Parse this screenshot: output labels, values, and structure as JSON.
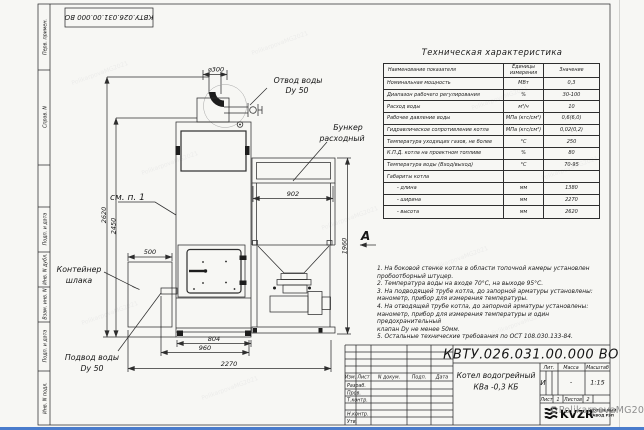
{
  "colors": {
    "bottom_bar": "#4a7ccc",
    "line_color": "#2e2e2e",
    "paper": "#f7f7f4",
    "watermark_gray": "#8f8f8f"
  },
  "page": {
    "doc_number_top": "КВТУ.026.031.00.000 ВО",
    "watermark": "©PolikarpovaMG2021",
    "watermark_tile": "PolikarpovaMG2021"
  },
  "border_column": {
    "labels": [
      "Перв. примен.",
      "Справ. N",
      "Подп. и дата",
      "Инв. N дубл.",
      "Взам. инв. N",
      "Подп. и дата",
      "Инв. N подл."
    ]
  },
  "tech_table": {
    "title": "Техническая характеристика",
    "headers": [
      "Наименование показателя",
      "Единицы измерения",
      "Значение"
    ],
    "rows": [
      {
        "name": "Номинальная мощность",
        "unit": "МВт",
        "value": "0,3"
      },
      {
        "name": "Диапазон рабочего регулирования",
        "unit": "%",
        "value": "30-100"
      },
      {
        "name": "Расход воды",
        "unit": "м³/ч",
        "value": "10"
      },
      {
        "name": "Рабочее давление воды",
        "unit": "МПа (кгс/см²)",
        "value": "0,6(6,0)"
      },
      {
        "name": "Гидравлическое сопротивление котла",
        "unit": "МПа (кгс/см²)",
        "value": "0,02(0,2)"
      },
      {
        "name": "Температура уходящих газов, не более",
        "unit": "°С",
        "value": "250"
      },
      {
        "name": "К.П.Д. котла на проектном топливе",
        "unit": "%",
        "value": "80"
      },
      {
        "name": "Температура воды (Вход/выход)",
        "unit": "°С",
        "value": "70-95"
      },
      {
        "name": "Габариты котла",
        "unit": "",
        "value": ""
      },
      {
        "name": "- длина",
        "unit": "мм",
        "value": "1380"
      },
      {
        "name": "- ширина",
        "unit": "мм",
        "value": "2270"
      },
      {
        "name": "- высота",
        "unit": "мм",
        "value": "2620"
      }
    ]
  },
  "notes": {
    "lines": [
      "1. На боковой стенке котла в области топочной камеры установлен",
      "пробоотборный штуцер.",
      "2. Температура воды на входе 70°С, на выходе 95°С.",
      "3. На подводящей трубе котла, до запорной арматуры установлены:",
      "манометр, прибор для измерения температуры.",
      "4. На отводящей трубе котла, до запорной арматуры установлены:",
      "манометр, прибор для измерения температуры и один предохранительный",
      "клапан Dy не менее 50мм.",
      "5. Остальные технические требования по ОСТ 108.030.133-84."
    ]
  },
  "drawing": {
    "view_label": "А",
    "see_note": "см. п. 1",
    "labels": {
      "water_outlet_1": "Отвод воды",
      "water_outlet_2": "Dy 50",
      "hopper_1": "Бункер",
      "hopper_2": "расходный",
      "slag_1": "Контейнер",
      "slag_2": "шлака",
      "water_inlet_1": "Подвод воды",
      "water_inlet_2": "Dy 50"
    },
    "dims": {
      "chimney": "⌀300",
      "hopper_w": "902",
      "slag_w": "500",
      "boiler_w": "804",
      "base_w": "960",
      "total_w": "2270",
      "total_h": "2620",
      "body_h": "2450",
      "hopper_h": "1960"
    }
  },
  "title_block": {
    "doc_number": "КВТУ.026.031.00.000 ВО",
    "cols": [
      "Изм.",
      "Лист",
      "N докум.",
      "Подп.",
      "Дата"
    ],
    "rows": [
      "Разраб.",
      "Пров.",
      "Т.контр.",
      "Н.контр.",
      "Утв."
    ],
    "product_line1": "Котел водогрейный",
    "product_line2": "КВа -0,3 КБ",
    "lit_label": "Лит.",
    "mass_label": "Масса",
    "scale_label": "Масштаб",
    "lit_value": "И",
    "mass_value": "-",
    "scale_value": "1:15",
    "sheet_label": "Лист",
    "sheet_value": "1",
    "sheets_label": "Листов",
    "sheets_value": "2",
    "company_logo": "KVZR",
    "company_line1": "КОТЕЛЬНЫЙ",
    "company_line2": "ЗАВОД РЭП"
  }
}
